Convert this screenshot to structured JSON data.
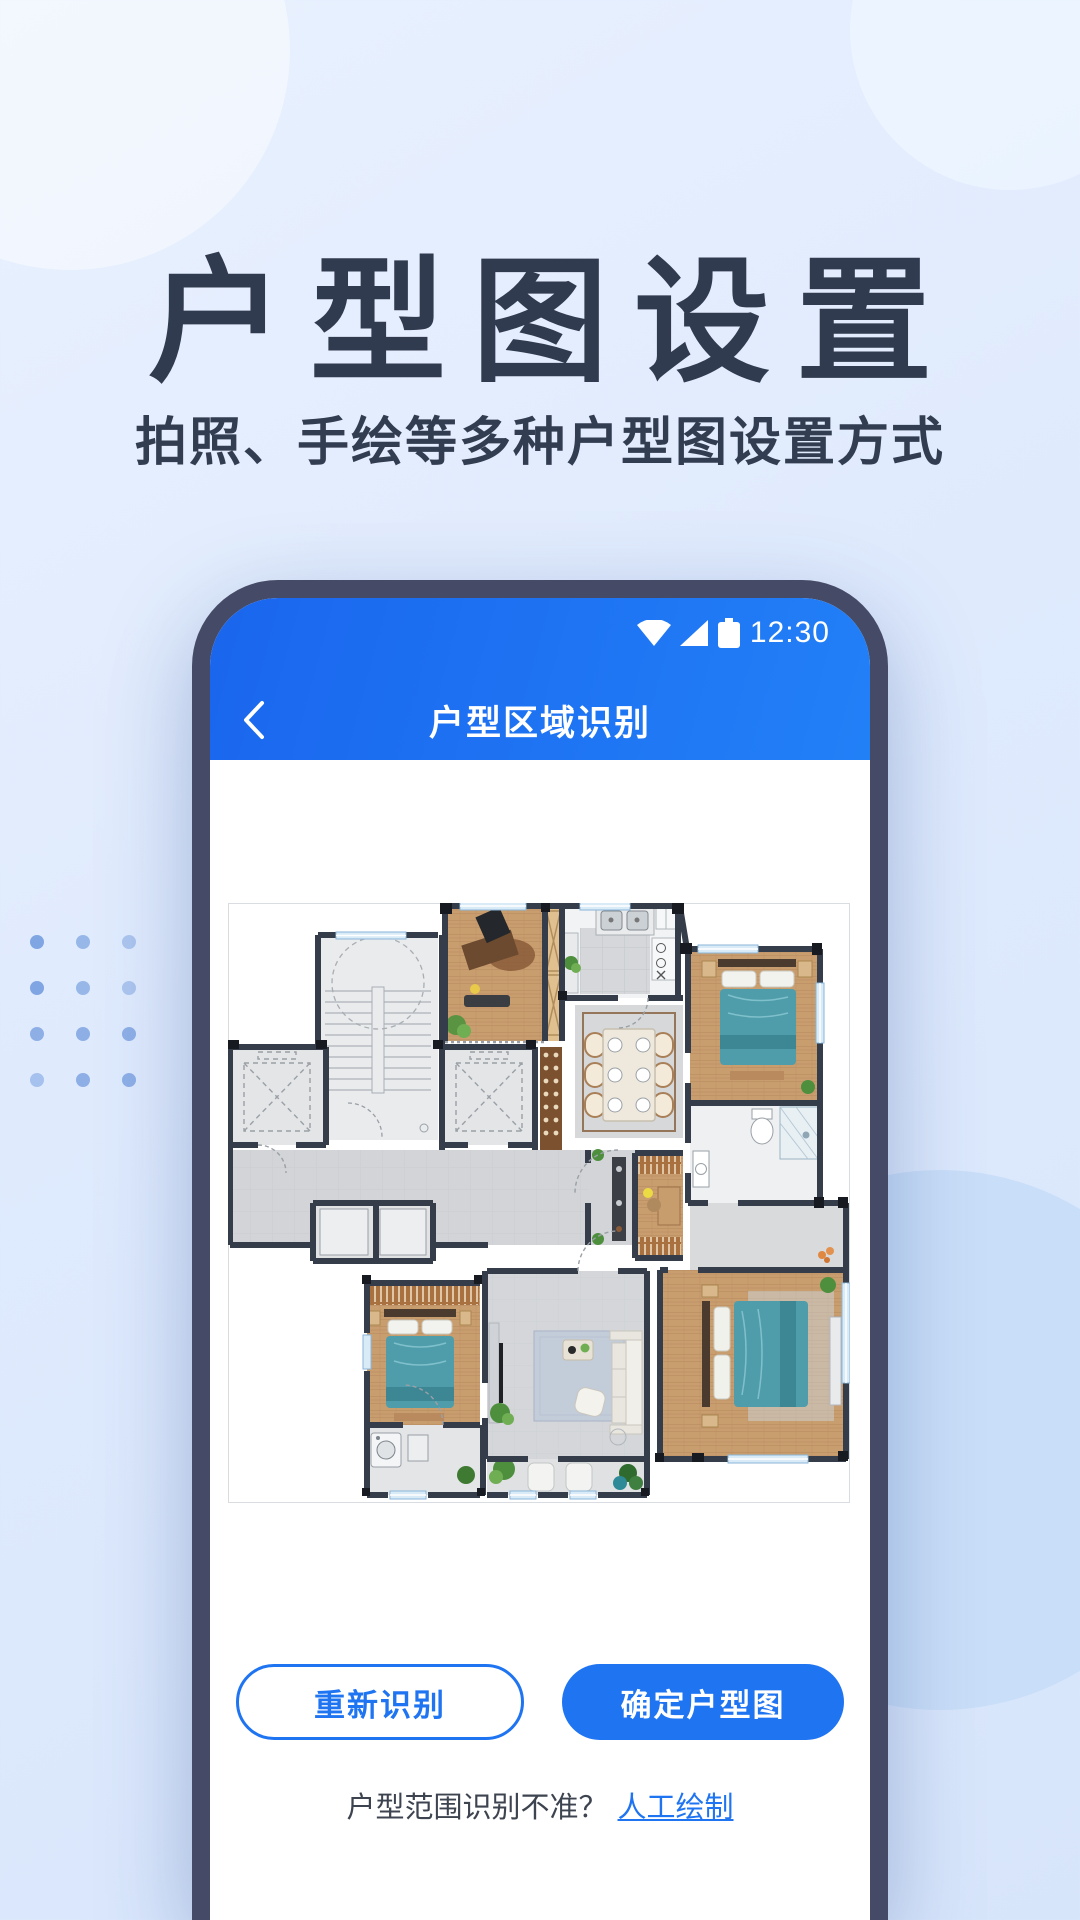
{
  "page": {
    "title": "户型图设置",
    "subtitle": "拍照、手绘等多种户型图设置方式"
  },
  "phone": {
    "status_bar": {
      "time": "12:30",
      "icons": [
        "wifi-icon",
        "cellular-signal-icon",
        "battery-icon"
      ]
    },
    "nav_bar": {
      "title": "户型区域识别",
      "back_icon": "chevron-left-icon"
    },
    "actions": {
      "retry_label": "重新识别",
      "confirm_label": "确定户型图"
    },
    "footer": {
      "question": "户型范围识别不准？",
      "link_label": "人工绘制"
    }
  },
  "colors": {
    "accent_blue": "#1f74f2",
    "header_blue_start": "#1a66ee",
    "header_blue_end": "#2280f7",
    "phone_bezel": "#454b66",
    "title_ink": "#313b4f",
    "page_background": "#dfeafd",
    "link_blue": "#1f74f2"
  }
}
